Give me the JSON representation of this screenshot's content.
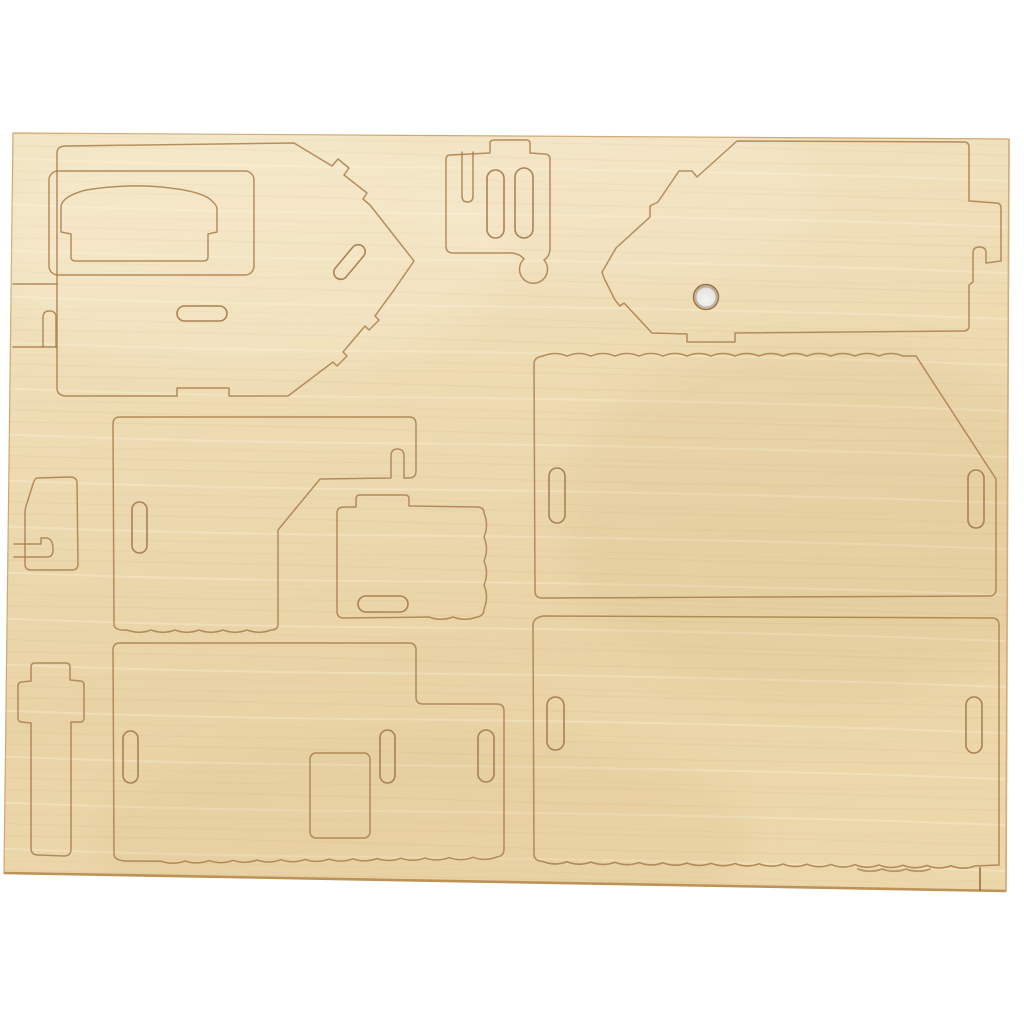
{
  "image": {
    "description": "Top-down product photo of a light birch plywood sheet with laser pre-cut press-out pieces for a 3D wooden house construction kit, on a white background",
    "object_type": "plywood 3d-puzzle cut sheet",
    "background_color": "#ffffff",
    "wood_color_light": "#f2e4c4",
    "wood_color_mid": "#ecd9b0",
    "wood_color_dark": "#e7d1a4",
    "cut_line_color": "#a97e4b",
    "deep_burn_color": "#8f6434",
    "through_hole": {
      "present": true,
      "shape": "circle",
      "approx_diameter_px": 25,
      "fill": "#e9e7e2"
    }
  },
  "sheet": {
    "material": "plywood",
    "piece_count": 12,
    "pieces": [
      {
        "name": "side-wall-pointed-right",
        "slots": 2,
        "notches": "stepped point edges, bottom tab notch"
      },
      {
        "name": "inner-rect-panel",
        "slots": 0
      },
      {
        "name": "arched-back-piece",
        "slots": 0
      },
      {
        "name": "small-bracket-with-two-slots",
        "slots": 2,
        "feature": "top tab, teardrop corner, open top notch"
      },
      {
        "name": "gable-end-left-point",
        "slots": 0,
        "holes": 1,
        "feature": "edge hook slot, bottom tab notch"
      },
      {
        "name": "roof-panel-upper",
        "slots": 2,
        "feature": "scalloped top edge, angled corner"
      },
      {
        "name": "mid-wall-panel",
        "slots": 2,
        "feature": "scalloped bottom, diagonal bite corner"
      },
      {
        "name": "small-panel-with-tab",
        "slots": 1,
        "feature": "scalloped right edge"
      },
      {
        "name": "lower-wall-panel",
        "slots": 3,
        "window_cutouts": 1,
        "feature": "scalloped bottom, stepped outline"
      },
      {
        "name": "roof-panel-lower",
        "slots": 2,
        "feature": "scalloped bottom edge"
      },
      {
        "name": "chimney-cross-piece",
        "slots": 0
      },
      {
        "name": "wedge-support",
        "slots": 1,
        "feature": "edge hook slot"
      }
    ]
  }
}
